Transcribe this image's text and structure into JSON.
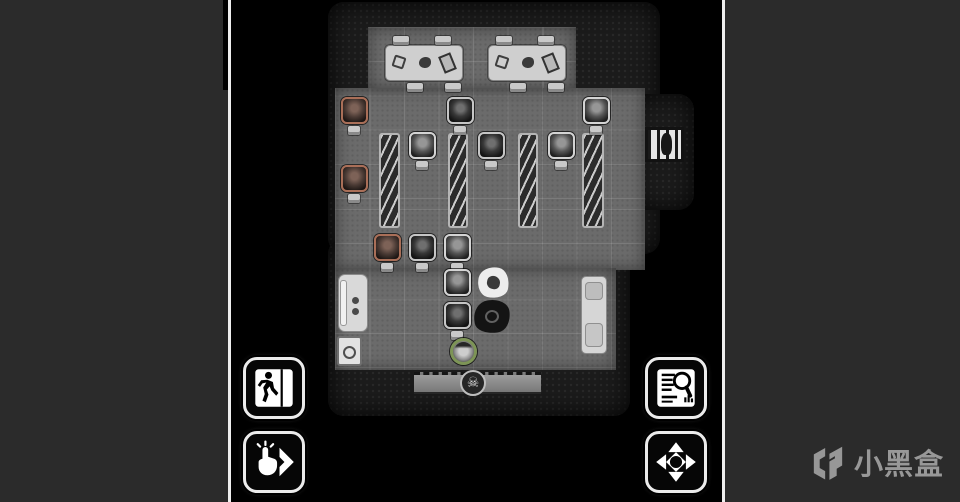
{
  "window": {
    "page_bg": "#2b2b2b",
    "canvas_bg": "#000000",
    "divider_color": "#eeeeee"
  },
  "watermark": {
    "text": "小黑盒",
    "color": "#989898",
    "logo": "heybox-logo"
  },
  "hud": {
    "buttons": [
      {
        "id": "exit-button",
        "icon": "exit-run-icon"
      },
      {
        "id": "tap-advance-button",
        "icon": "tap-hand-chevron-icon"
      },
      {
        "id": "inspect-button",
        "icon": "document-magnifier-icon"
      },
      {
        "id": "move-pan-button",
        "icon": "four-arrows-icon"
      }
    ]
  },
  "map": {
    "skull_glyph": "☠",
    "palette": {
      "floor": "#6b6b6b",
      "rock": "#1b1b1b",
      "token_frame": "#d4d4d4",
      "token_frame_red": "#aa6f58",
      "player_ring": "#7d9456"
    },
    "entities": [
      {
        "t": "rock",
        "x": 97,
        "y": 2,
        "w": 332,
        "h": 252,
        "n": "cave-wall",
        "i": false
      },
      {
        "t": "rock",
        "x": 97,
        "y": 238,
        "w": 302,
        "h": 178,
        "n": "cave-wall",
        "i": false
      },
      {
        "t": "rock",
        "x": 399,
        "y": 94,
        "w": 64,
        "h": 116,
        "n": "cave-wall",
        "i": false
      },
      {
        "t": "floor",
        "x": 137,
        "y": 27,
        "w": 208,
        "h": 63,
        "n": "floor-tiles",
        "i": true
      },
      {
        "t": "floor",
        "x": 104,
        "y": 88,
        "w": 310,
        "h": 182,
        "n": "floor-tiles",
        "i": true
      },
      {
        "t": "floor",
        "x": 104,
        "y": 268,
        "w": 281,
        "h": 102,
        "n": "floor-tiles",
        "i": true
      },
      {
        "t": "door",
        "x": 414,
        "y": 127,
        "w": 39,
        "h": 35,
        "n": "barred-doorway",
        "i": true
      },
      {
        "t": "bridge",
        "x": 183,
        "y": 372,
        "w": 127,
        "h": 22,
        "n": "bridge-plank",
        "i": false
      },
      {
        "t": "skull",
        "x": 229,
        "y": 370,
        "w": 26,
        "h": 26,
        "n": "skull-marker",
        "i": false
      },
      {
        "t": "table",
        "x": 154,
        "y": 45,
        "w": 78,
        "h": 36,
        "n": "table",
        "i": false
      },
      {
        "t": "table",
        "x": 257,
        "y": 45,
        "w": 78,
        "h": 36,
        "n": "table",
        "i": false
      },
      {
        "t": "tchair",
        "x": 162,
        "y": 36,
        "w": 16,
        "h": 9,
        "n": "chair",
        "i": false
      },
      {
        "t": "tchair",
        "x": 204,
        "y": 36,
        "w": 16,
        "h": 9,
        "n": "chair",
        "i": false
      },
      {
        "t": "tchair",
        "x": 176,
        "y": 83,
        "w": 16,
        "h": 9,
        "n": "chair",
        "i": false
      },
      {
        "t": "tchair",
        "x": 214,
        "y": 83,
        "w": 16,
        "h": 9,
        "n": "chair",
        "i": false
      },
      {
        "t": "tchair",
        "x": 265,
        "y": 36,
        "w": 16,
        "h": 9,
        "n": "chair",
        "i": false
      },
      {
        "t": "tchair",
        "x": 307,
        "y": 36,
        "w": 16,
        "h": 9,
        "n": "chair",
        "i": false
      },
      {
        "t": "tchair",
        "x": 279,
        "y": 83,
        "w": 16,
        "h": 9,
        "n": "chair",
        "i": false
      },
      {
        "t": "tchair",
        "x": 317,
        "y": 83,
        "w": 16,
        "h": 9,
        "n": "chair",
        "i": false
      },
      {
        "t": "shelf",
        "x": 148,
        "y": 133,
        "w": 21,
        "h": 95,
        "n": "bookshelf",
        "i": false
      },
      {
        "t": "shelf",
        "x": 217,
        "y": 133,
        "w": 20,
        "h": 95,
        "n": "bookshelf",
        "i": false
      },
      {
        "t": "shelf",
        "x": 287,
        "y": 133,
        "w": 20,
        "h": 95,
        "n": "bookshelf",
        "i": false
      },
      {
        "t": "shelf",
        "x": 351,
        "y": 133,
        "w": 22,
        "h": 95,
        "n": "bookshelf",
        "i": false
      },
      {
        "t": "token",
        "x": 110,
        "y": 97,
        "w": 27,
        "h": 27,
        "f": "red",
        "n": "enemy-token",
        "i": true
      },
      {
        "t": "token",
        "x": 110,
        "y": 165,
        "w": 27,
        "h": 27,
        "f": "red",
        "n": "enemy-token",
        "i": true
      },
      {
        "t": "token",
        "x": 216,
        "y": 97,
        "w": 27,
        "h": 27,
        "f": "dk",
        "n": "enemy-token",
        "i": true
      },
      {
        "t": "token",
        "x": 352,
        "y": 97,
        "w": 27,
        "h": 27,
        "f": "std",
        "n": "enemy-token",
        "i": true
      },
      {
        "t": "token",
        "x": 178,
        "y": 132,
        "w": 27,
        "h": 27,
        "f": "std",
        "n": "enemy-token",
        "i": true
      },
      {
        "t": "token",
        "x": 247,
        "y": 132,
        "w": 27,
        "h": 27,
        "f": "dk",
        "n": "enemy-token",
        "i": true
      },
      {
        "t": "token",
        "x": 317,
        "y": 132,
        "w": 27,
        "h": 27,
        "f": "std",
        "n": "enemy-token",
        "i": true
      },
      {
        "t": "token",
        "x": 143,
        "y": 234,
        "w": 27,
        "h": 27,
        "f": "red",
        "n": "enemy-token",
        "i": true
      },
      {
        "t": "token",
        "x": 178,
        "y": 234,
        "w": 27,
        "h": 27,
        "f": "dk",
        "n": "enemy-token",
        "i": true
      },
      {
        "t": "token",
        "x": 213,
        "y": 234,
        "w": 27,
        "h": 27,
        "f": "std",
        "n": "enemy-token",
        "i": true
      },
      {
        "t": "token",
        "x": 213,
        "y": 269,
        "w": 27,
        "h": 27,
        "f": "std",
        "n": "enemy-token",
        "i": true
      },
      {
        "t": "token",
        "x": 213,
        "y": 302,
        "w": 27,
        "h": 27,
        "f": "dk",
        "n": "enemy-token",
        "i": true
      },
      {
        "t": "chair",
        "x": 117,
        "y": 126,
        "w": 12,
        "h": 9,
        "n": "chair",
        "i": false
      },
      {
        "t": "chair",
        "x": 117,
        "y": 194,
        "w": 12,
        "h": 9,
        "n": "chair",
        "i": false
      },
      {
        "t": "chair",
        "x": 223,
        "y": 126,
        "w": 12,
        "h": 9,
        "n": "chair",
        "i": false
      },
      {
        "t": "chair",
        "x": 359,
        "y": 126,
        "w": 12,
        "h": 9,
        "n": "chair",
        "i": false
      },
      {
        "t": "chair",
        "x": 185,
        "y": 161,
        "w": 12,
        "h": 9,
        "n": "chair",
        "i": false
      },
      {
        "t": "chair",
        "x": 254,
        "y": 161,
        "w": 12,
        "h": 9,
        "n": "chair",
        "i": false
      },
      {
        "t": "chair",
        "x": 324,
        "y": 161,
        "w": 12,
        "h": 9,
        "n": "chair",
        "i": false
      },
      {
        "t": "chair",
        "x": 150,
        "y": 263,
        "w": 12,
        "h": 9,
        "n": "chair",
        "i": false
      },
      {
        "t": "chair",
        "x": 185,
        "y": 263,
        "w": 12,
        "h": 9,
        "n": "chair",
        "i": false
      },
      {
        "t": "chair",
        "x": 220,
        "y": 263,
        "w": 12,
        "h": 9,
        "n": "chair",
        "i": false
      },
      {
        "t": "chair",
        "x": 220,
        "y": 331,
        "w": 12,
        "h": 9,
        "n": "chair",
        "i": false
      },
      {
        "t": "splatw",
        "x": 247,
        "y": 267,
        "w": 31,
        "h": 31,
        "n": "white-splat",
        "i": false
      },
      {
        "t": "splatd",
        "x": 243,
        "y": 300,
        "w": 36,
        "h": 33,
        "n": "dark-splat",
        "i": false
      },
      {
        "t": "player",
        "x": 219,
        "y": 338,
        "w": 27,
        "h": 27,
        "n": "player-token",
        "i": true
      },
      {
        "t": "bed",
        "x": 107,
        "y": 274,
        "w": 30,
        "h": 58,
        "n": "bed",
        "i": false
      },
      {
        "t": "crate",
        "x": 106,
        "y": 336,
        "w": 25,
        "h": 30,
        "n": "crate",
        "i": false
      },
      {
        "t": "shelfr",
        "x": 350,
        "y": 276,
        "w": 26,
        "h": 78,
        "n": "shelf",
        "i": false
      }
    ]
  }
}
